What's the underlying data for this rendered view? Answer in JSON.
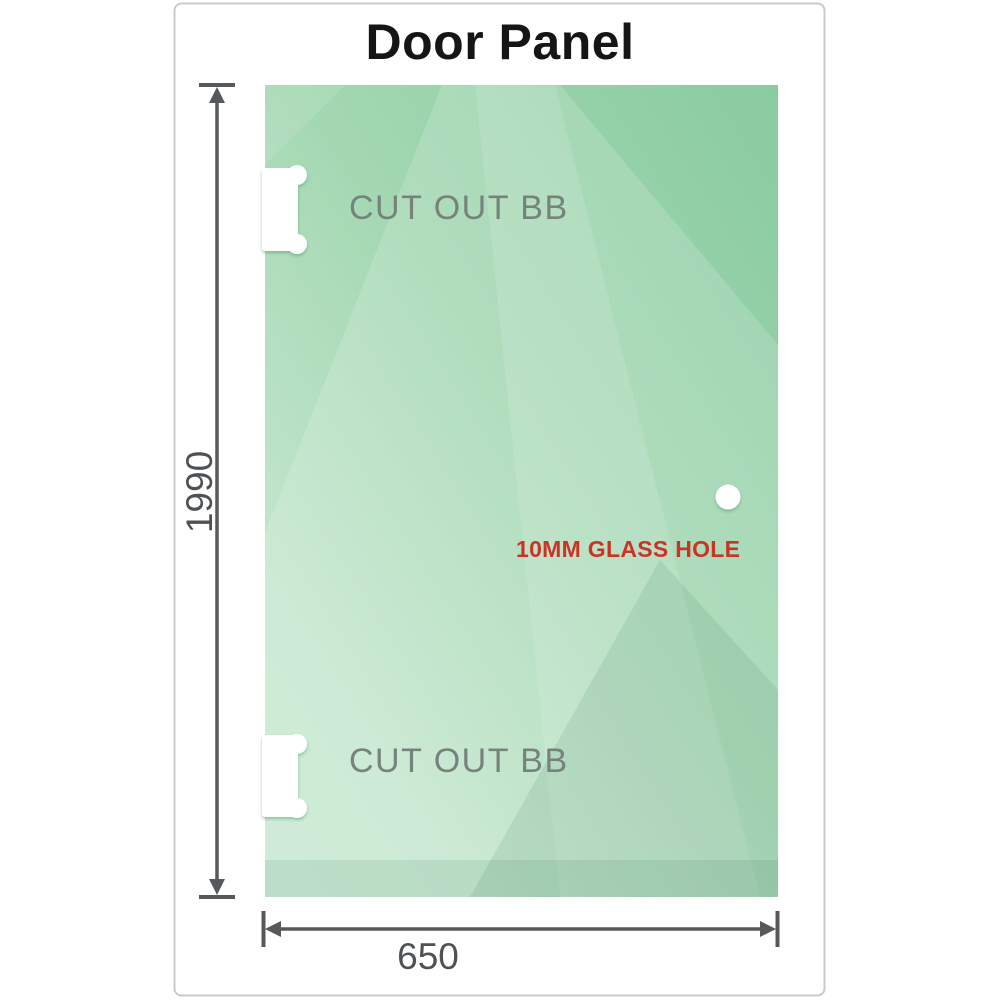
{
  "title": "Door Panel",
  "panel": {
    "cutouts": [
      {
        "label": "CUT OUT BB",
        "position": "top-left-edge"
      },
      {
        "label": "CUT OUT BB",
        "position": "bottom-left-edge"
      }
    ],
    "hole": {
      "label": "10MM GLASS HOLE",
      "position": "middle-right"
    }
  },
  "dimensions": {
    "height": {
      "value": "1990",
      "orientation": "vertical"
    },
    "width": {
      "value": "650",
      "orientation": "horizontal"
    }
  },
  "colors": {
    "glass_base": "#8acba1",
    "glass_light": "#c8e9d2",
    "dimension_lines": "#56595b",
    "hole_label_red": "#cb3425",
    "cutout_label_gray": "#76837c",
    "frame_border": "#c7cbcd",
    "title_text": "#151515"
  }
}
